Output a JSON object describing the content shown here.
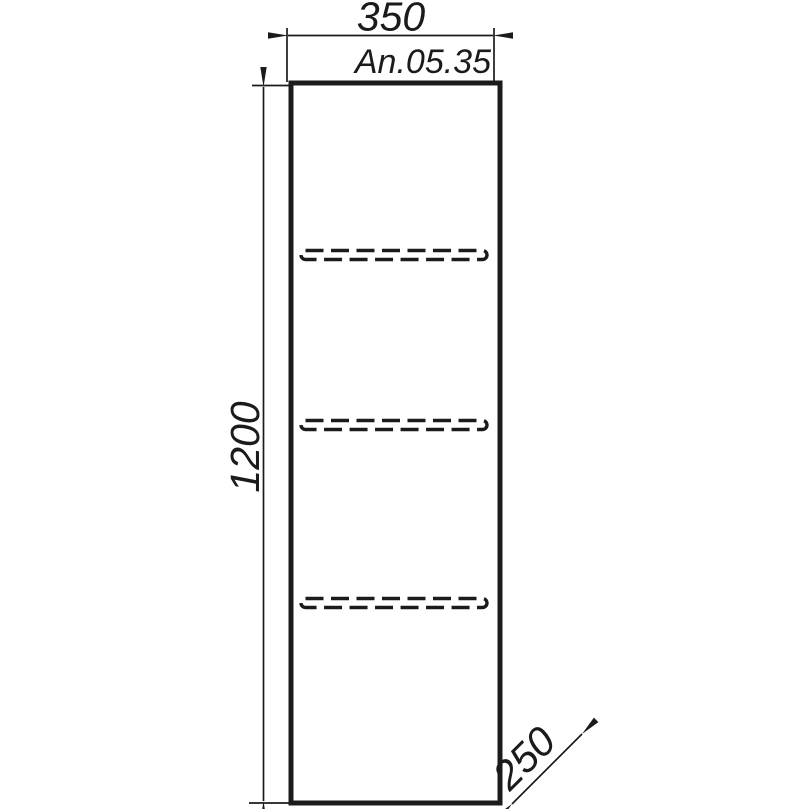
{
  "colors": {
    "line": "#1b1b1b",
    "background": "#ffffff"
  },
  "drawing": {
    "product_code": "An.05.35",
    "width_dim": "350",
    "height_dim": "1200",
    "depth_dim": "250",
    "shelf_count": 3
  }
}
